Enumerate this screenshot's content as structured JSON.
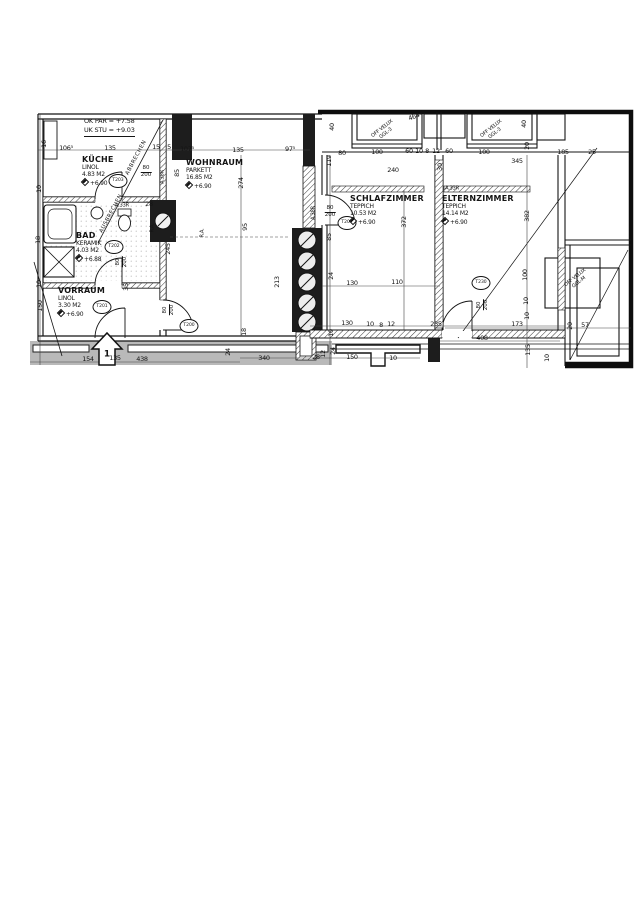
{
  "plan": {
    "notes": {
      "line1": "OK PAR = +7.58",
      "line2": "UK STU = +9.03"
    },
    "entrance_arrow": {
      "label": "1"
    },
    "rooms": [
      {
        "name": "KÜCHE",
        "floor": "LINOL",
        "area": "4.83 M2",
        "level": "+6.90",
        "x": 82,
        "y": 155
      },
      {
        "name": "WOHNRAUM",
        "floor": "PARKETT",
        "area": "16.85 M2",
        "level": "+6.90",
        "x": 186,
        "y": 158
      },
      {
        "name": "BAD",
        "floor": "KERAMIK",
        "area": "4.03 M2",
        "level": "+6.88",
        "x": 76,
        "y": 231
      },
      {
        "name": "VORRAUM",
        "floor": "LINOL",
        "area": "3.30 M2",
        "level": "+6.90",
        "x": 58,
        "y": 286
      },
      {
        "name": "SCHLAFZIMMER",
        "floor": "TEPPICH",
        "area": "10.53 M2",
        "level": "+6.90",
        "x": 350,
        "y": 194
      },
      {
        "name": "ELTERNZIMMER",
        "floor": "TEPPICH",
        "area": "14.14 M2",
        "level": "+6.90",
        "x": 442,
        "y": 194
      }
    ],
    "dimensions": [
      {
        "t": "106⁵",
        "x": 66,
        "y": 148
      },
      {
        "t": "135",
        "x": 110,
        "y": 148
      },
      {
        "t": "15",
        "x": 156,
        "y": 147
      },
      {
        "t": "5",
        "x": 169,
        "y": 147
      },
      {
        "t": "107⁵",
        "x": 187,
        "y": 149
      },
      {
        "t": "135",
        "x": 238,
        "y": 150
      },
      {
        "t": "97⁵",
        "x": 290,
        "y": 149
      },
      {
        "t": "80",
        "x": 342,
        "y": 153
      },
      {
        "t": "100",
        "x": 377,
        "y": 152
      },
      {
        "t": "60",
        "x": 409,
        "y": 151
      },
      {
        "t": "10",
        "x": 419,
        "y": 151
      },
      {
        "t": "8",
        "x": 427,
        "y": 151
      },
      {
        "t": "12",
        "x": 436,
        "y": 151
      },
      {
        "t": "60",
        "x": 449,
        "y": 151
      },
      {
        "t": "100",
        "x": 484,
        "y": 152
      },
      {
        "t": "185",
        "x": 563,
        "y": 152
      },
      {
        "t": "25",
        "x": 592,
        "y": 152
      },
      {
        "t": "464",
        "x": 414,
        "y": 117,
        "r": -20
      },
      {
        "t": "40",
        "x": 332,
        "y": 127,
        "r": -90
      },
      {
        "t": "40",
        "x": 524,
        "y": 124,
        "r": -90
      },
      {
        "t": "20",
        "x": 527,
        "y": 146,
        "r": -90
      },
      {
        "t": "240",
        "x": 393,
        "y": 170
      },
      {
        "t": "30",
        "x": 440,
        "y": 167,
        "r": -90
      },
      {
        "t": "345",
        "x": 517,
        "y": 161
      },
      {
        "t": "119",
        "x": 329,
        "y": 161,
        "r": -90
      },
      {
        "t": "85",
        "x": 177,
        "y": 173,
        "r": -90
      },
      {
        "t": "274",
        "x": 241,
        "y": 183,
        "r": -90
      },
      {
        "t": "95",
        "x": 245,
        "y": 227,
        "r": -90
      },
      {
        "t": "28",
        "x": 149,
        "y": 204
      },
      {
        "t": "245",
        "x": 168,
        "y": 249,
        "r": -90
      },
      {
        "t": "35",
        "x": 126,
        "y": 287,
        "r": -90
      },
      {
        "t": "16",
        "x": 44,
        "y": 144,
        "r": -90
      },
      {
        "t": "10",
        "x": 39,
        "y": 189,
        "r": -90
      },
      {
        "t": "18",
        "x": 38,
        "y": 240,
        "r": -90
      },
      {
        "t": "10",
        "x": 39,
        "y": 284,
        "r": -90
      },
      {
        "t": "150",
        "x": 40,
        "y": 306,
        "r": -90
      },
      {
        "t": "213",
        "x": 277,
        "y": 282,
        "r": -90
      },
      {
        "t": "85",
        "x": 329,
        "y": 237,
        "r": -90
      },
      {
        "t": "24",
        "x": 331,
        "y": 276,
        "r": -90
      },
      {
        "t": "130",
        "x": 352,
        "y": 283
      },
      {
        "t": "110",
        "x": 397,
        "y": 282
      },
      {
        "t": "130",
        "x": 347,
        "y": 323
      },
      {
        "t": "10",
        "x": 370,
        "y": 324
      },
      {
        "t": "8",
        "x": 381,
        "y": 325
      },
      {
        "t": "12",
        "x": 391,
        "y": 324
      },
      {
        "t": "372",
        "x": 404,
        "y": 222,
        "r": -90
      },
      {
        "t": "382",
        "x": 527,
        "y": 216,
        "r": -90
      },
      {
        "t": "235",
        "x": 436,
        "y": 324
      },
      {
        "t": "173",
        "x": 517,
        "y": 324
      },
      {
        "t": "20",
        "x": 570,
        "y": 326,
        "r": -90
      },
      {
        "t": "57",
        "x": 585,
        "y": 325
      },
      {
        "t": "408",
        "x": 482,
        "y": 338
      },
      {
        "t": "100",
        "x": 525,
        "y": 275,
        "r": -90
      },
      {
        "t": "10",
        "x": 526,
        "y": 301,
        "r": -90
      },
      {
        "t": "10",
        "x": 527,
        "y": 316,
        "r": -90
      },
      {
        "t": "135",
        "x": 528,
        "y": 350,
        "r": -90
      },
      {
        "t": "10",
        "x": 547,
        "y": 358,
        "r": -90
      },
      {
        "t": "10",
        "x": 331,
        "y": 333,
        "r": -90
      },
      {
        "t": "12",
        "x": 323,
        "y": 354,
        "r": -90
      },
      {
        "t": "24",
        "x": 333,
        "y": 351,
        "r": -90
      },
      {
        "t": "18",
        "x": 244,
        "y": 332,
        "r": -90
      },
      {
        "t": "24",
        "x": 228,
        "y": 352,
        "r": -90
      },
      {
        "t": "340",
        "x": 264,
        "y": 358
      },
      {
        "t": "28",
        "x": 316,
        "y": 357
      },
      {
        "t": "150",
        "x": 352,
        "y": 357
      },
      {
        "t": "10",
        "x": 393,
        "y": 358
      },
      {
        "t": "154",
        "x": 88,
        "y": 359
      },
      {
        "t": "135",
        "x": 115,
        "y": 358
      },
      {
        "t": "438",
        "x": 142,
        "y": 359
      }
    ],
    "door_tags": [
      {
        "t": "T203",
        "x": 118,
        "y": 181
      },
      {
        "t": "T202",
        "x": 114,
        "y": 247
      },
      {
        "t": "T201",
        "x": 102,
        "y": 307
      },
      {
        "t": "T200",
        "x": 189,
        "y": 326
      },
      {
        "t": "T204",
        "x": 347,
        "y": 223
      },
      {
        "t": "T230",
        "x": 481,
        "y": 283
      }
    ],
    "door_sizes": [
      {
        "w": "80",
        "h": "200",
        "x": 146,
        "y": 172,
        "r": 0
      },
      {
        "w": "80",
        "h": "200",
        "x": 330,
        "y": 212,
        "r": 0
      },
      {
        "w": "80",
        "h": "200",
        "x": 122,
        "y": 262,
        "r": -90
      },
      {
        "w": "80",
        "h": "200",
        "x": 169,
        "y": 310,
        "r": -90
      },
      {
        "w": "80",
        "h": "200",
        "x": 483,
        "y": 305,
        "r": -90
      }
    ],
    "radiators": [
      {
        "t": "A.38R",
        "x": 163,
        "y": 177,
        "r": -90
      },
      {
        "t": "A.38R",
        "x": 314,
        "y": 213,
        "r": -90
      },
      {
        "t": "A.33R",
        "x": 122,
        "y": 206,
        "r": 0
      },
      {
        "t": "A.33R",
        "x": 452,
        "y": 189,
        "r": 0
      },
      {
        "t": "R.A.",
        "x": 153,
        "y": 228,
        "r": -90
      },
      {
        "t": "R.A.",
        "x": 203,
        "y": 233,
        "r": -90
      }
    ],
    "velux_windows": [
      {
        "l1": "OFF VELUX",
        "l2": "GGL-3",
        "x": 384,
        "y": 131,
        "r": -38
      },
      {
        "l1": "OFF VELUX",
        "l2": "GGL-3",
        "x": 493,
        "y": 131,
        "r": -38
      },
      {
        "l1": "OFF VELUX",
        "l2": "GGL-M",
        "x": 577,
        "y": 280,
        "r": -38
      }
    ],
    "demolition_notes": [
      {
        "t": "ABBRECHEN",
        "x": 137,
        "y": 158,
        "r": -62
      },
      {
        "t": "AUSBRECHEN",
        "x": 112,
        "y": 214,
        "r": -62
      }
    ],
    "colors": {
      "line": "#141414",
      "wall_fill": "#1d1d1d",
      "exterior_band": "#b9b9b9",
      "paper": "#ffffff"
    }
  }
}
